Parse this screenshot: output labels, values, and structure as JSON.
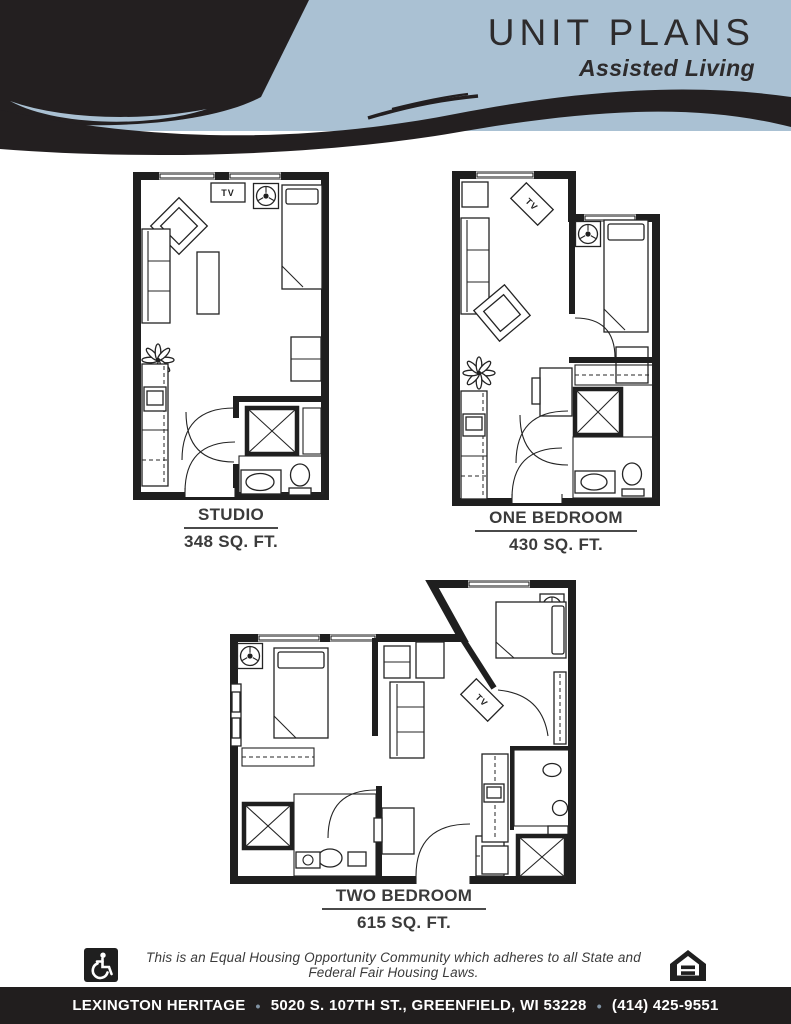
{
  "header": {
    "title": "UNIT PLANS",
    "subtitle": "Assisted Living"
  },
  "plans": [
    {
      "id": "studio",
      "name": "STUDIO",
      "area": "348 SQ. FT."
    },
    {
      "id": "one-bedroom",
      "name": "ONE BEDROOM",
      "area": "430 SQ. FT."
    },
    {
      "id": "two-bedroom",
      "name": "TWO BEDROOM",
      "area": "615 SQ. FT."
    }
  ],
  "plan_annotations": {
    "tv": "TV"
  },
  "footer": {
    "eho_statement": "This is an Equal Housing Opportunity Community which adheres to all State and Federal Fair Housing Laws.",
    "community_name": "LEXINGTON HERITAGE",
    "address": "5020 S. 107TH ST., GREENFIELD, WI 53228",
    "phone": "(414) 425-9551",
    "separator": "•"
  },
  "colors": {
    "band_blue": "#aac1d3",
    "ink_black": "#231f20",
    "bar_dark": "#211e1e",
    "text_dark": "#3b3b3b"
  }
}
